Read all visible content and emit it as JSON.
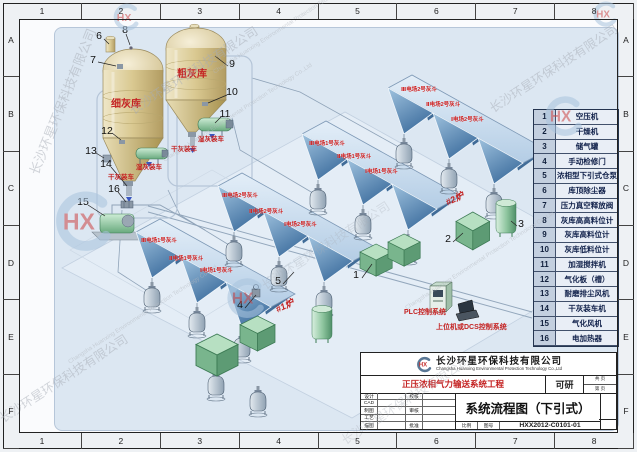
{
  "zones": {
    "cols": [
      "1",
      "2",
      "3",
      "4",
      "5",
      "6",
      "7",
      "8"
    ],
    "rows": [
      "A",
      "B",
      "C",
      "D",
      "E",
      "F"
    ]
  },
  "legend": {
    "rows": [
      {
        "n": "1",
        "t": "空压机"
      },
      {
        "n": "2",
        "t": "干燥机"
      },
      {
        "n": "3",
        "t": "储气罐"
      },
      {
        "n": "4",
        "t": "手动检修门"
      },
      {
        "n": "5",
        "t": "浓相型下引式仓泵"
      },
      {
        "n": "6",
        "t": "库顶除尘器"
      },
      {
        "n": "7",
        "t": "压力真空释放阀"
      },
      {
        "n": "8",
        "t": "灰库高高料位计"
      },
      {
        "n": "9",
        "t": "灰库高料位计"
      },
      {
        "n": "10",
        "t": "灰库低料位计"
      },
      {
        "n": "11",
        "t": "加湿搅拌机"
      },
      {
        "n": "12",
        "t": "气化板（槽）"
      },
      {
        "n": "13",
        "t": "耐磨排尘风机"
      },
      {
        "n": "14",
        "t": "干灰装车机"
      },
      {
        "n": "15",
        "t": "气化风机"
      },
      {
        "n": "16",
        "t": "电加热器"
      }
    ]
  },
  "title_block": {
    "logo": "HX",
    "company": "长沙环星环保科技有限公司",
    "company_en": "Changsha Huanxing Environmental Protection Technology Co.,Ltd",
    "project": "正压浓相气力输送系统工程",
    "stage": "可研",
    "pages_top": "共 页",
    "pages_bottom": "第 页",
    "drawing_title": "系统流程图（下引式）",
    "scale_label": "比例",
    "no_label": "图号",
    "drawing_no": "HXX2012-C0101-01",
    "fields": {
      "design": "设计",
      "cad": "CAD",
      "draft": "制图",
      "process": "工艺",
      "trace": "描图",
      "check": "校核",
      "review": "审核",
      "approve": "批准"
    }
  },
  "diagram": {
    "red_labels": [
      {
        "t": "细灰库",
        "x": 111,
        "y": 95,
        "cls": "lbl-silo"
      },
      {
        "t": "粗灰库",
        "x": 177,
        "y": 65,
        "cls": "lbl-silo"
      },
      {
        "t": "湿灰装车",
        "x": 198,
        "y": 133,
        "cls": "lbl-sm"
      },
      {
        "t": "干灰装车",
        "x": 171,
        "y": 143,
        "cls": "lbl-sm"
      },
      {
        "t": "湿灰装车",
        "x": 136,
        "y": 161,
        "cls": "lbl-sm"
      },
      {
        "t": "干灰装车",
        "x": 108,
        "y": 171,
        "cls": "lbl-sm"
      },
      {
        "t": "#1炉",
        "x": 276,
        "y": 303,
        "cls": "lbl-boiler"
      },
      {
        "t": "#2炉",
        "x": 446,
        "y": 196,
        "cls": "lbl-boiler"
      },
      {
        "t": "PLC控制系统",
        "x": 404,
        "y": 307,
        "cls": "lbl-ctrl"
      },
      {
        "t": "上位机或DCS控制系统",
        "x": 436,
        "y": 322,
        "cls": "lbl-ctrl"
      }
    ],
    "hopper_labels": [
      {
        "t": "Ⅲ电场2号灰斗",
        "x": 401,
        "y": 85
      },
      {
        "t": "Ⅱ电场2号灰斗",
        "x": 426,
        "y": 100
      },
      {
        "t": "Ⅰ电场2号灰斗",
        "x": 451,
        "y": 115
      },
      {
        "t": "Ⅲ电场1号灰斗",
        "x": 309,
        "y": 139
      },
      {
        "t": "Ⅱ电场1号灰斗",
        "x": 337,
        "y": 152
      },
      {
        "t": "Ⅰ电场1号灰斗",
        "x": 365,
        "y": 167
      },
      {
        "t": "Ⅲ电场2号灰斗",
        "x": 222,
        "y": 191
      },
      {
        "t": "Ⅱ电场2号灰斗",
        "x": 249,
        "y": 207
      },
      {
        "t": "Ⅰ电场2号灰斗",
        "x": 284,
        "y": 220
      },
      {
        "t": "Ⅲ电场1号灰斗",
        "x": 141,
        "y": 236
      },
      {
        "t": "Ⅱ电场1号灰斗",
        "x": 169,
        "y": 254
      },
      {
        "t": "Ⅰ电场1号灰斗",
        "x": 200,
        "y": 266
      }
    ],
    "callouts": [
      {
        "n": "1",
        "x": 356,
        "y": 275
      },
      {
        "n": "2",
        "x": 448,
        "y": 239
      },
      {
        "n": "3",
        "x": 521,
        "y": 224
      },
      {
        "n": "4",
        "x": 240,
        "y": 305
      },
      {
        "n": "5",
        "x": 278,
        "y": 281
      },
      {
        "n": "6",
        "x": 99,
        "y": 36
      },
      {
        "n": "7",
        "x": 93,
        "y": 60
      },
      {
        "n": "8",
        "x": 125,
        "y": 30
      },
      {
        "n": "9",
        "x": 232,
        "y": 64
      },
      {
        "n": "10",
        "x": 232,
        "y": 92
      },
      {
        "n": "11",
        "x": 225,
        "y": 114
      },
      {
        "n": "12",
        "x": 107,
        "y": 131
      },
      {
        "n": "13",
        "x": 91,
        "y": 151
      },
      {
        "n": "14",
        "x": 106,
        "y": 164
      },
      {
        "n": "15",
        "x": 83,
        "y": 202
      },
      {
        "n": "16",
        "x": 114,
        "y": 189
      }
    ]
  },
  "watermark": {
    "cn": "长沙环星环保科技有限公司",
    "en": "Changsha Huanxing Environmental Protection Technology Co.,Ltd",
    "logo": "HX"
  }
}
